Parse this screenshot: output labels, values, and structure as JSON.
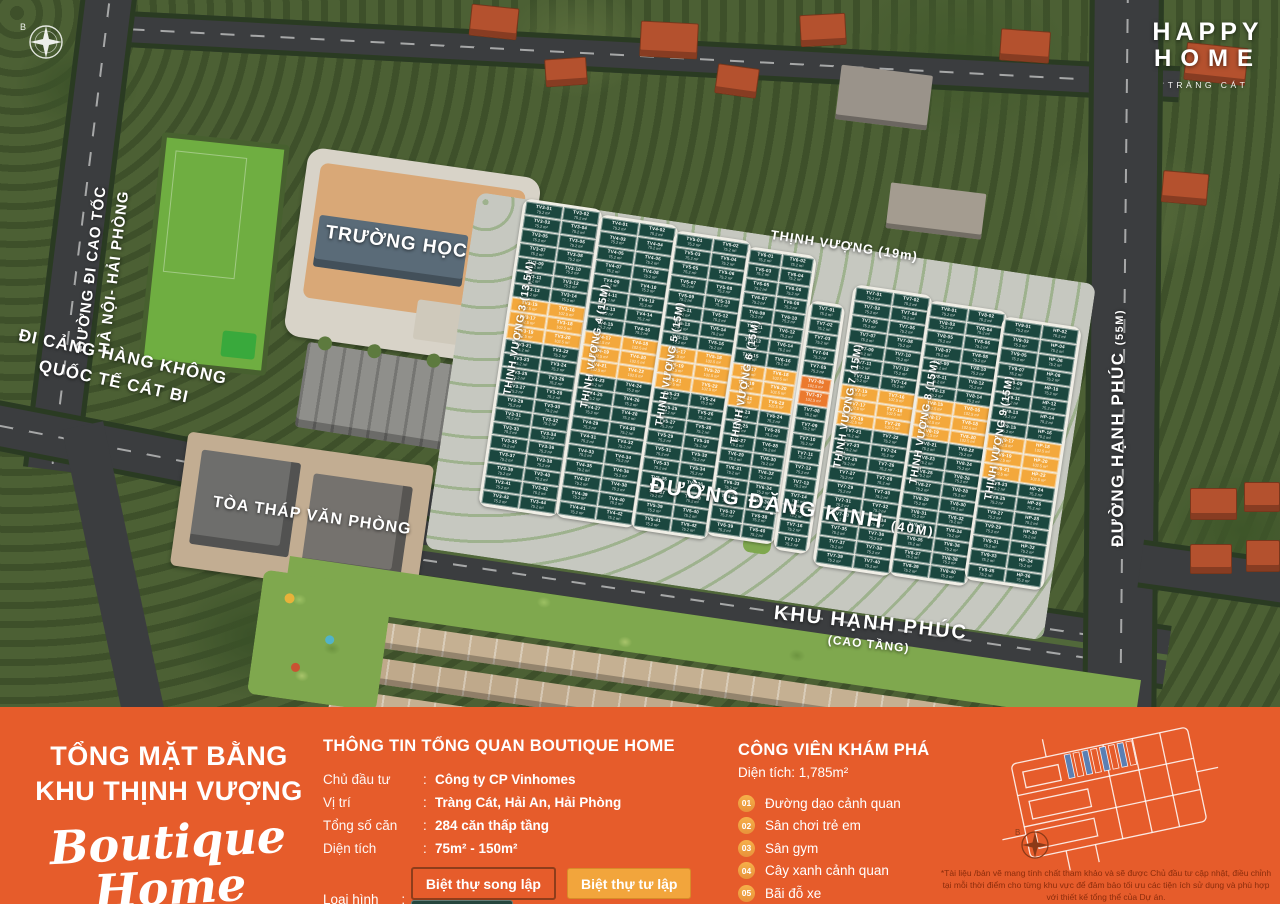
{
  "logo": {
    "line1": "HAPPY",
    "line2": "HOME",
    "subtitle": "TRÀNG CÁT"
  },
  "compass": {
    "north_label": "B"
  },
  "map": {
    "roads": [
      {
        "id": "cao-toc",
        "label": "ĐƯỜNG ĐI CAO TỐC",
        "label2": "HÀ NỘI- HẢI PHÒNG"
      },
      {
        "id": "cat-bi",
        "label": "ĐI CẢNG HÀNG KHÔNG",
        "label2": "QUỐC TẾ CÁT BI"
      },
      {
        "id": "thinh-vuong-19",
        "label": "THỊNH VƯỢNG (19m)"
      },
      {
        "id": "dang-kinh",
        "label": "ĐƯỜNG ĐẶNG KINH",
        "size": "(40M)"
      },
      {
        "id": "hanh-phuc",
        "label": "ĐƯỜNG HẠNH PHÚC",
        "size": "(55M)"
      }
    ],
    "areas": [
      {
        "id": "school",
        "label": "TRƯỜNG HỌC"
      },
      {
        "id": "office-tower",
        "label": "TÒA THÁP VĂN PHÒNG"
      },
      {
        "id": "khu-hanh-phuc",
        "label": "KHU HẠNH PHÚC",
        "sublabel": "(CAO TẦNG)"
      }
    ],
    "lot": {
      "green_area": "75.2 m²",
      "orange_area": "102.5 m²"
    },
    "blocks": [
      {
        "street_label": "THỊNH VƯỢNG 3 (13,5M)",
        "prefixes": [
          "TV3",
          "TV3"
        ],
        "rows": 22,
        "orange_start": 7,
        "orange_len": 3
      },
      {
        "street_label": "THỊNH VƯỢNG 4 (15M)",
        "prefixes": [
          "TV4",
          "TV4"
        ],
        "rows": 21,
        "orange_start": 8,
        "orange_len": 3
      },
      {
        "street_label": "THỊNH VƯỢNG 5 (15M)",
        "prefixes": [
          "TV5",
          "TV5"
        ],
        "rows": 21,
        "orange_start": 8,
        "orange_len": 3
      },
      {
        "street_label": "THỊNH VƯỢNG 6 (15M)",
        "prefixes": [
          "TV6",
          "TV6"
        ],
        "rows": 20,
        "orange_start": 8,
        "orange_len": 3
      },
      {
        "street_label": "THỊNH VƯỢNG 7 (15M)",
        "prefixes": [
          "TV7",
          "TV7"
        ],
        "rows": 20,
        "orange_start": 7,
        "orange_len": 3
      },
      {
        "street_label": "THỊNH VƯỢNG 8 (15M)",
        "prefixes": [
          "TV8",
          "TV8"
        ],
        "rows": 20,
        "orange_start": 7,
        "orange_len": 3
      },
      {
        "street_label": "THỊNH VƯỢNG 9 (15M)",
        "prefixes": [
          "TV9",
          "HP"
        ],
        "rows": 18,
        "orange_start": 8,
        "orange_len": 3
      }
    ],
    "strip_block": {
      "prefix": "TV7",
      "rows": 17,
      "orange_start": 5,
      "orange_len": 2
    }
  },
  "footer": {
    "left": {
      "title_line1": "TỔNG MẶT BẰNG",
      "title_line2": "KHU THỊNH VƯỢNG",
      "script": "Boutique Home"
    },
    "info": {
      "title": "THÔNG TIN TỔNG QUAN BOUTIQUE HOME",
      "rows": [
        {
          "label": "Chủ đầu tư",
          "value": "Công ty CP Vinhomes"
        },
        {
          "label": "Vị trí",
          "value": "Tràng Cát, Hải An, Hải Phòng"
        },
        {
          "label": "Tổng số căn",
          "value": "284 căn thấp tầng"
        },
        {
          "label": "Diện tích",
          "value": "75m² - 150m²"
        }
      ],
      "type_label": "Loại hình",
      "types": [
        {
          "label": "Biệt thự song lập",
          "style": "chip-outline",
          "color": "#e65c2b"
        },
        {
          "label": "Biệt thự tư lập",
          "style": "chip-yellow",
          "color": "#f2a53c"
        },
        {
          "label": "Nhà liền kề",
          "style": "chip-teal",
          "color": "#25473e"
        }
      ]
    },
    "park": {
      "title": "CÔNG VIÊN KHÁM PHÁ",
      "area": "Diện tích: 1,785m²",
      "items": [
        {
          "num": "01",
          "label": "Đường dạo cảnh quan"
        },
        {
          "num": "02",
          "label": "Sân chơi trẻ em"
        },
        {
          "num": "03",
          "label": "Sân gym"
        },
        {
          "num": "04",
          "label": "Cây xanh cảnh quan"
        },
        {
          "num": "05",
          "label": "Bãi đỗ xe"
        }
      ]
    },
    "disclaimer": "*Tài liệu /bản vẽ mang tính chất tham khảo và sẽ được Chủ đầu tư cập nhật, điều chỉnh tại mỗi thời điểm cho từng khu vực để đảm bảo tối ưu các tiện ích sử dụng và phù hợp với thiết kế tổng thể của Dự án."
  },
  "colors": {
    "bar_orange": "#e65c2b",
    "lot_green": "#1b473f",
    "lot_yellow": "#f3a83c",
    "lot_orange": "#eb7a2e"
  }
}
